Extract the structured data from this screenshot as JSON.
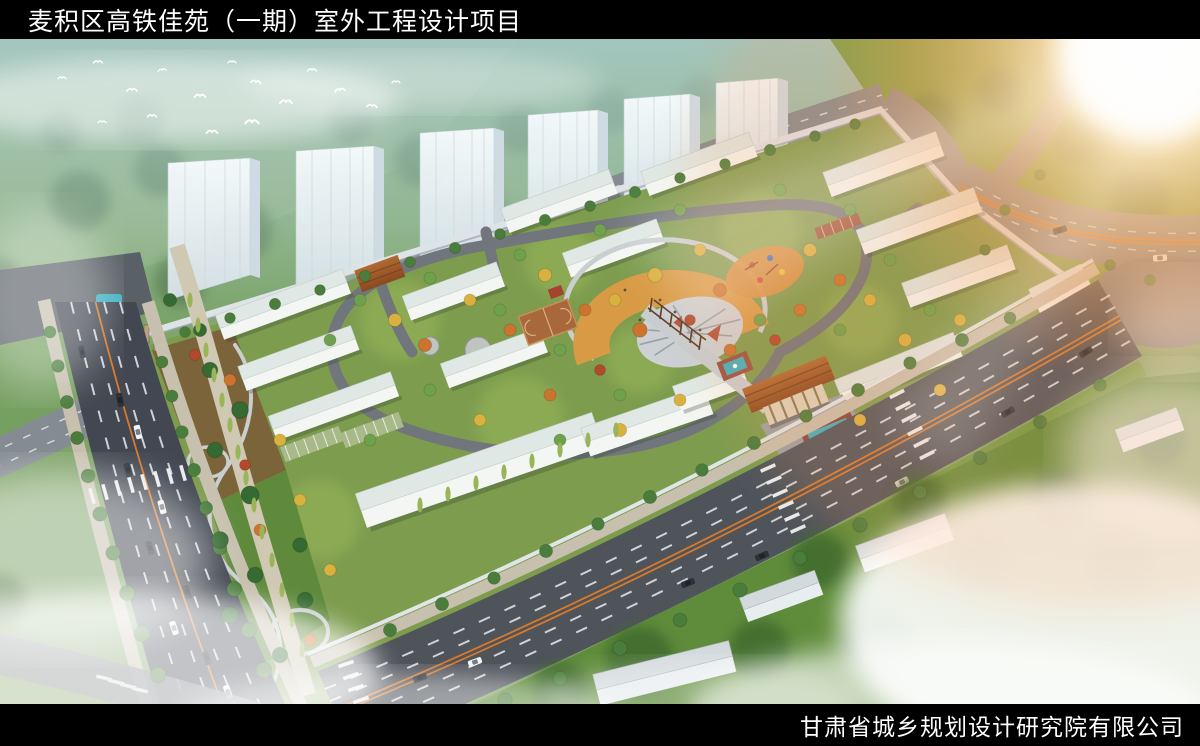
{
  "header": {
    "title": "麦积区高铁佳苑（一期）室外工程设计项目"
  },
  "footer": {
    "company": "甘肃省城乡规划设计研究院有限公司"
  },
  "palette": {
    "bar_background": "#000000",
    "title_color": "#ffffff",
    "asphalt": "#4f545b",
    "asphalt_dark": "#424751",
    "lane_marking": "#e8eaec",
    "center_line_orange": "#e07b28",
    "plaza_orange": "#d89a44",
    "lawn_green": "#7d9c4e",
    "tower_glass": "#e9f1f5",
    "roof_light": "#dfe8e4",
    "gate_roof_brown": "#9c5a28",
    "pool_water": "#3fb0c2",
    "sun_glare": "#ffb36b",
    "hill_green": "#7fa368",
    "field_green": "#5f8c3b"
  }
}
